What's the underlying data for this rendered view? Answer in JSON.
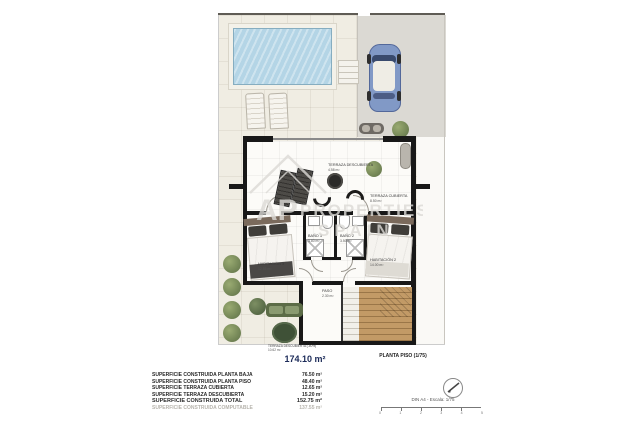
{
  "plan": {
    "title": "174.10 m²",
    "drawing_label": "PLANTA PISO (1/75)",
    "rooms": {
      "terraza_descubierta": {
        "name": "TERRAZA DESCUBIERTA",
        "area": "4.58 m²"
      },
      "terraza_cubierta": {
        "name": "TERRAZA CUBIERTA",
        "area": "8.50 m²"
      },
      "habitacion3": {
        "name": "HABITACIÓN 3",
        "area": "12.55 m²"
      },
      "habitacion2": {
        "name": "HABITACIÓN 2",
        "area": "14.00 m²"
      },
      "bano3": {
        "name": "BAÑO 3",
        "area": "3.80 m²"
      },
      "bano2": {
        "name": "BAÑO 2",
        "area": "3.50 m²"
      },
      "paso": {
        "name": "PASO",
        "area": "2.30 m²"
      },
      "terraza_garden": {
        "name": "TERRAZA DESCUBIERTA (-50%)",
        "area": "10.62 m²"
      }
    },
    "legend": {
      "rows": [
        {
          "label": "SUPERFICIE CONSTRUIDA PLANTA BAJA",
          "value": "76.50 m²"
        },
        {
          "label": "SUPERFICIE CONSTRUIDA PLANTA PISO",
          "value": "48.40 m²"
        },
        {
          "label": "SUPERFICIE TERRAZA CUBIERTA",
          "value": "12.65 m²"
        },
        {
          "label": "SUPERFICIE TERRAZA DESCUBIERTA",
          "value": "15.20 m²"
        },
        {
          "label": "SUPERFICIE CONSTRUIDA TOTAL",
          "value": "152.75 m²"
        },
        {
          "label": "SUPERFICIE CONSTRUIDA COMPUTABLE",
          "value": "137.55 m²"
        }
      ]
    },
    "scale": {
      "text": "DIN A4 - Escala: 1/75",
      "ticks": [
        "0",
        "1",
        "2",
        "3",
        "4",
        "5"
      ]
    },
    "watermark": {
      "top": "AP",
      "middle": "PROPERTIES",
      "bottom": "SPAIN"
    },
    "colors": {
      "pool": "#b4d5e6",
      "car": "#8199c6",
      "plot": "#f0ede3",
      "driveway": "#dbd9d3",
      "wood": "#b68f5f",
      "garden_green": "#7d8f63",
      "title_accent": "#1b2a58"
    }
  }
}
